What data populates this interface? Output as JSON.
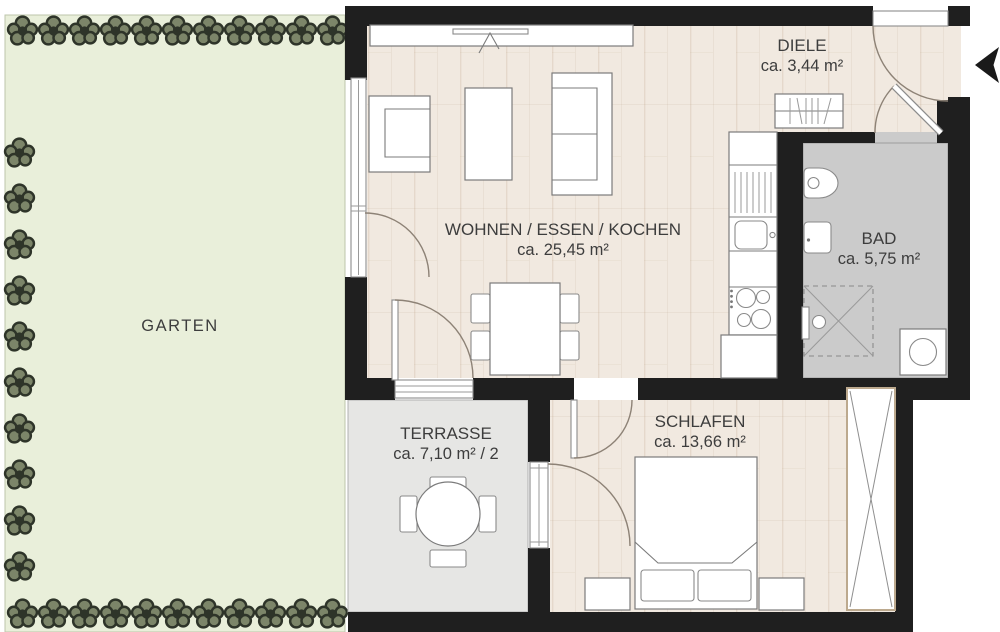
{
  "rooms": {
    "garten": {
      "label": "GARTEN"
    },
    "diele": {
      "label": "DIELE",
      "area": "ca. 3,44 m²"
    },
    "wohnen": {
      "label": "WOHNEN / ESSEN / KOCHEN",
      "area": "ca. 25,45 m²"
    },
    "bad": {
      "label": "BAD",
      "area": "ca. 5,75 m²"
    },
    "terrasse": {
      "label": "TERRASSE",
      "area": "ca. 7,10 m² / 2"
    },
    "schlafen": {
      "label": "SCHLAFEN",
      "area": "ca. 13,66 m²"
    }
  },
  "colors": {
    "wall": "#1f1f1f",
    "wood_floor": "#f1e9e0",
    "wood_grain": "#dccdbd",
    "terrace_floor": "#e6e6e4",
    "bath_floor": "#cbcbcb",
    "garden": "#e9efda",
    "hedge_dark": "#2e3429",
    "hedge_fill": "#7c8569",
    "door_arc": "#8d8276",
    "text": "#3d3d3d"
  }
}
